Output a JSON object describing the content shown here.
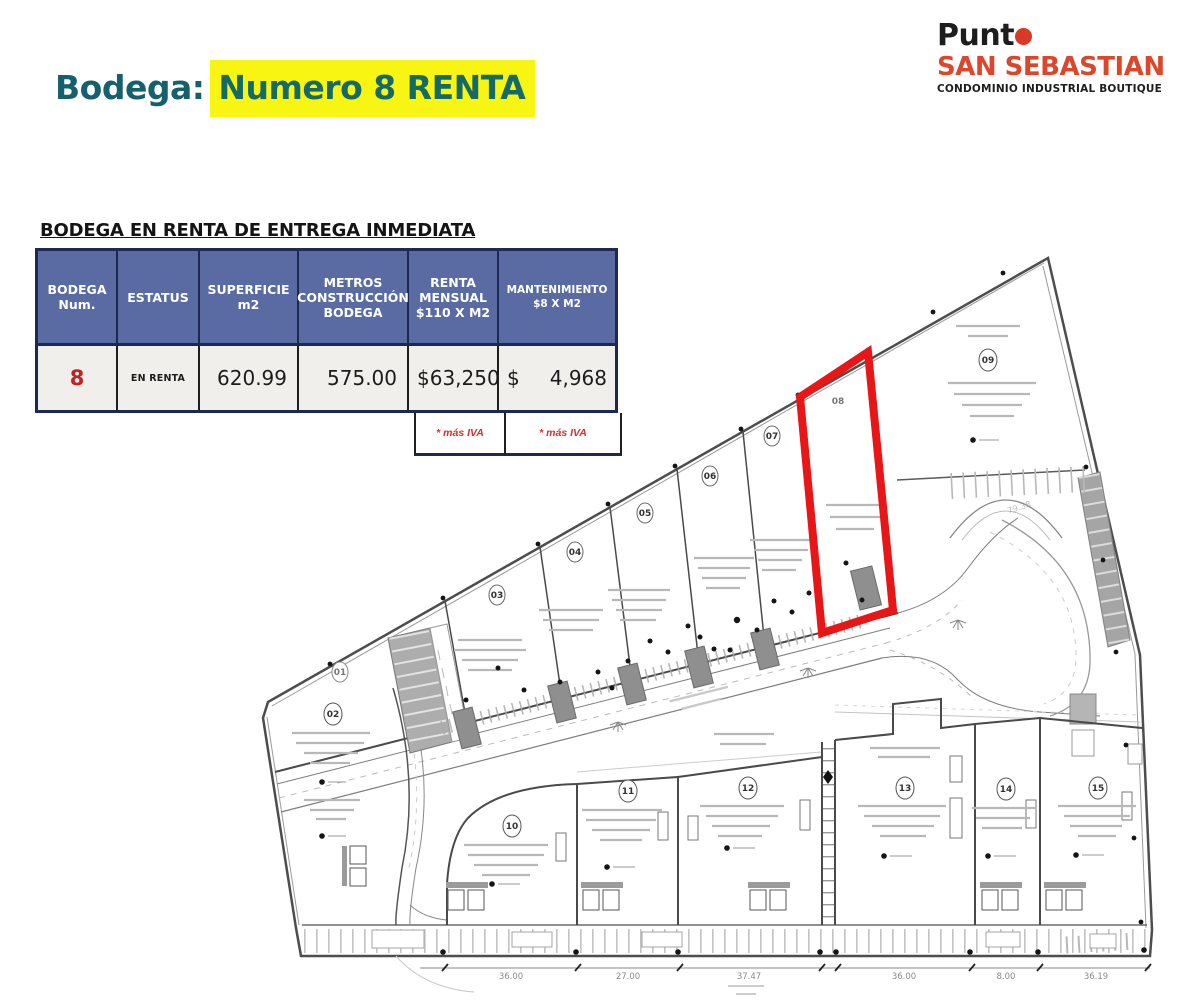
{
  "title": {
    "prefix": "Bodega:",
    "highlight": "Numero 8 RENTA"
  },
  "brand": {
    "name_prefix": "Punt",
    "line2": "SAN SEBASTIAN",
    "line3": "CONDOMINIO INDUSTRIAL BOUTIQUE"
  },
  "listing": {
    "subtitle": "BODEGA EN RENTA DE ENTREGA INMEDIATA"
  },
  "table": {
    "headers": [
      {
        "lines": [
          "BODEGA",
          "Num."
        ]
      },
      {
        "lines": [
          "ESTATUS"
        ]
      },
      {
        "lines": [
          "SUPERFICIE",
          "m2"
        ]
      },
      {
        "lines": [
          "METROS",
          "CONSTRUCCIÓN",
          "BODEGA"
        ]
      },
      {
        "lines": [
          "RENTA",
          "MENSUAL",
          "$110 X M2"
        ]
      },
      {
        "lines": [
          "MANTENIMIENTO",
          "$8 X M2"
        ]
      }
    ],
    "row": {
      "bodega_num": "8",
      "estatus": "EN RENTA",
      "superficie": "620.99",
      "construccion": "575.00",
      "renta_sign": "$",
      "renta_amount": "63,250",
      "mantenimiento_sign": "$",
      "mantenimiento_amount": "4,968"
    },
    "notes": {
      "renta": "* más IVA",
      "mantenimiento": "* más IVA"
    }
  },
  "siteplan": {
    "units": {
      "u01": "01",
      "u02": "02",
      "u03": "03",
      "u04": "04",
      "u05": "05",
      "u06": "06",
      "u07": "07",
      "u08": "08",
      "u09": "09",
      "u10": "10",
      "u11": "11",
      "u12": "12",
      "u13": "13",
      "u14": "14",
      "u15": "15"
    },
    "highlighted_unit": "08",
    "edge_label": "79.38",
    "dimensions": [
      "36.00",
      "27.00",
      "37.47",
      "36.00",
      "8.00",
      "36.19"
    ]
  },
  "colors": {
    "title_teal": "#15606f",
    "highlight_yellow": "#f8f512",
    "brand_red": "#dc472c",
    "table_header_blue": "#5a6ba4",
    "table_border_navy": "#1c2950",
    "unit_highlight_red": "#e81616",
    "accent_red_text": "#c42020"
  }
}
